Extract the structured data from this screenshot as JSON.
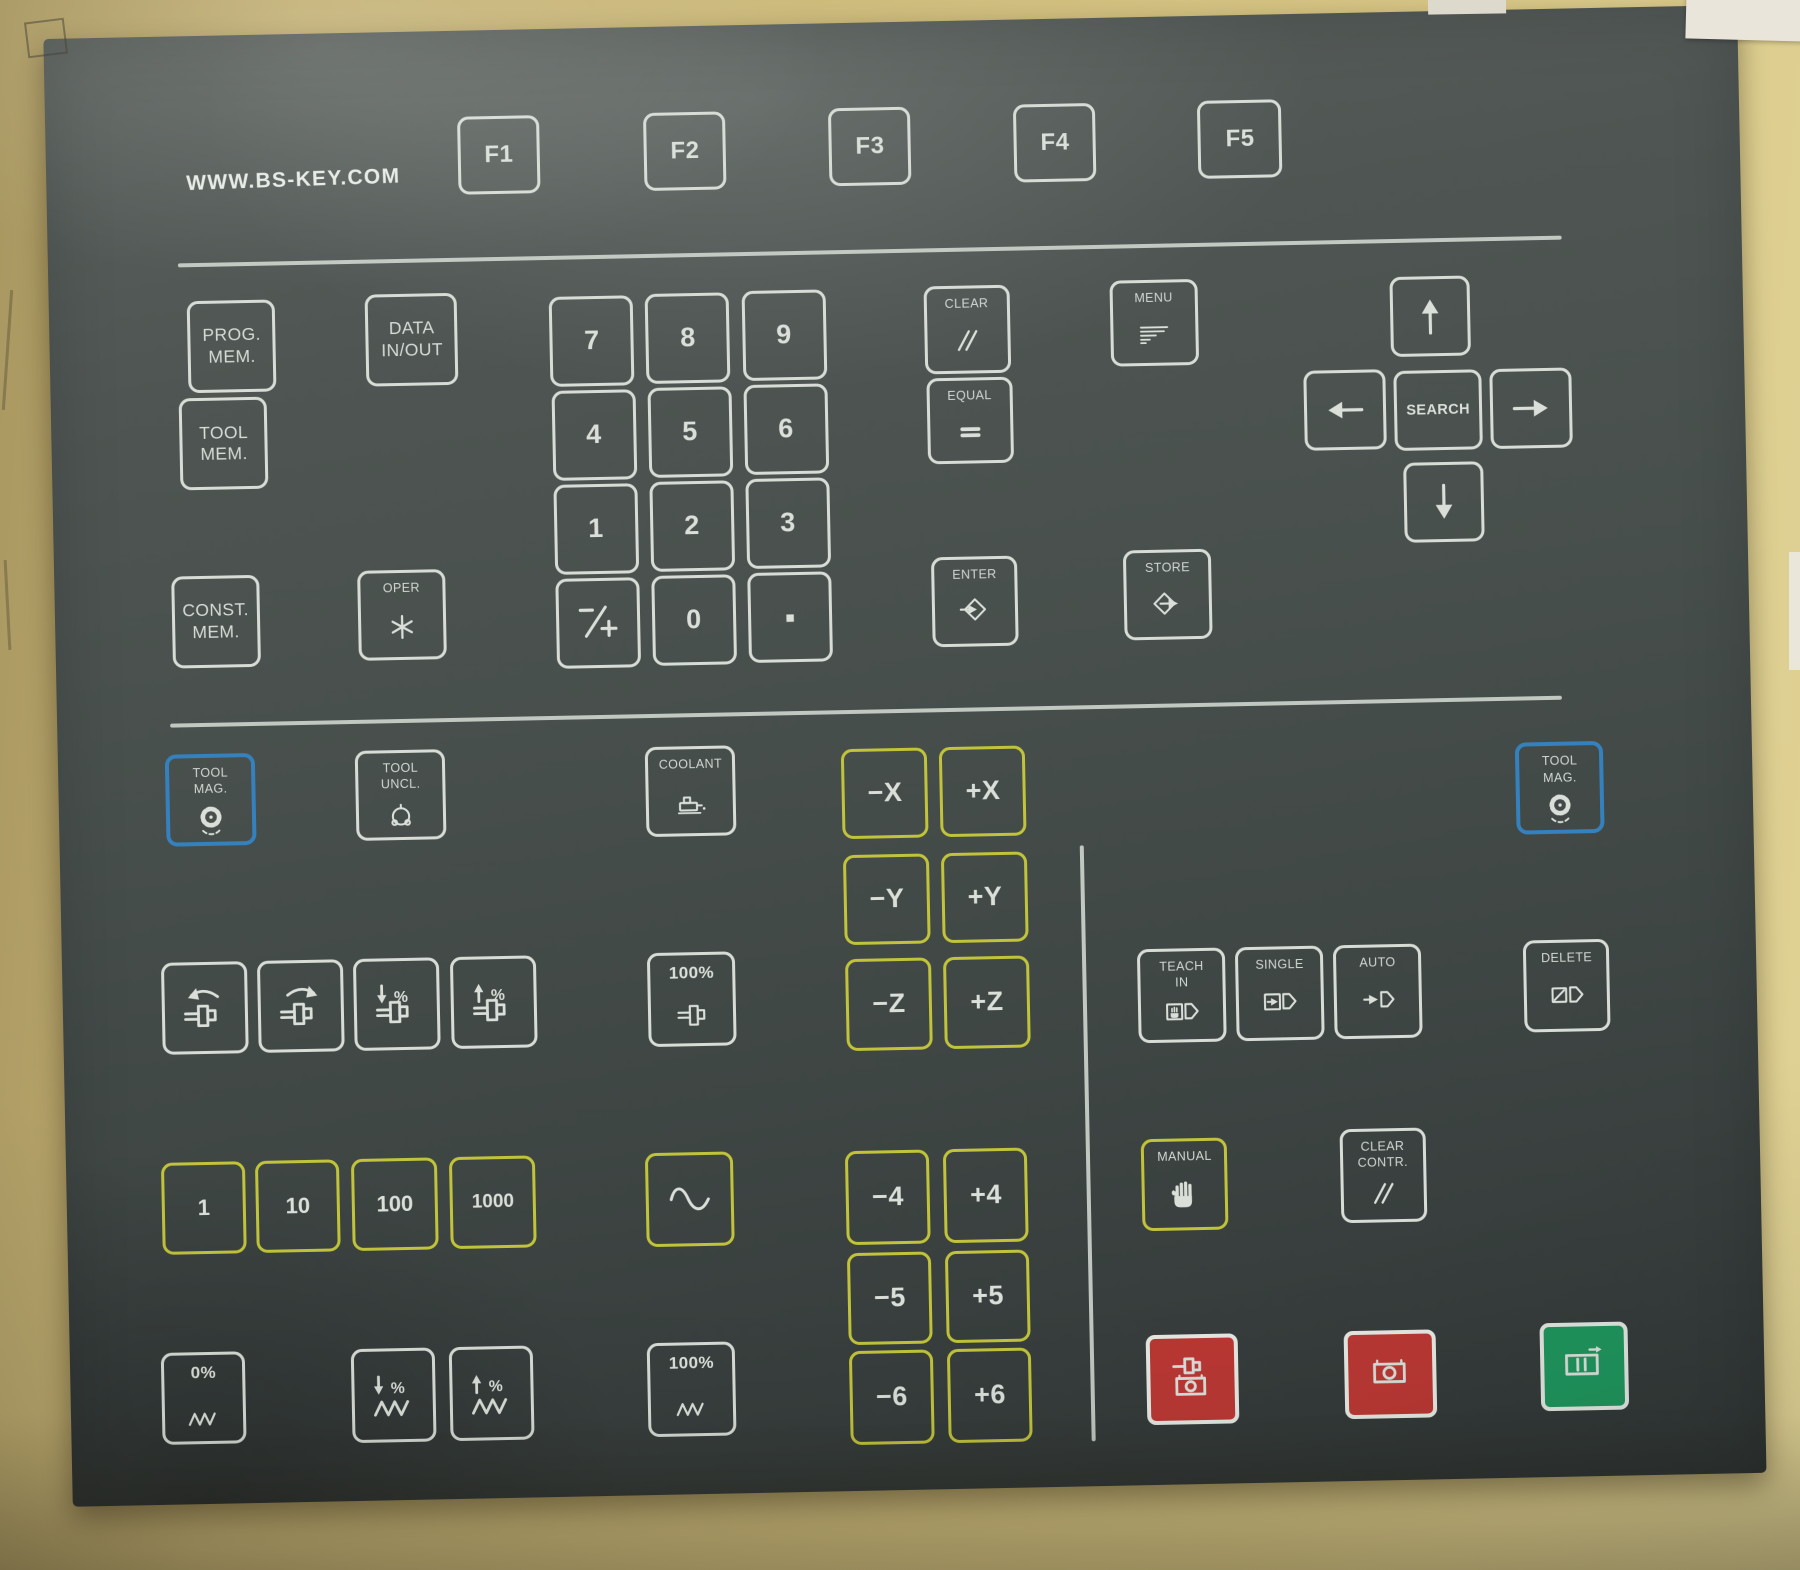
{
  "brand": "WWW.BS-KEY.COM",
  "colors": {
    "panel": "#454d4a",
    "key_outline": "#d7dcd6",
    "yellow": "#c2c431",
    "blue": "#2f82c4",
    "red": "#c23531",
    "green": "#18965a",
    "cardboard": "#cfbd7e"
  },
  "keys": {
    "f1": {
      "style": "white",
      "text": "F1"
    },
    "f2": {
      "style": "white",
      "text": "F2"
    },
    "f3": {
      "style": "white",
      "text": "F3"
    },
    "f4": {
      "style": "white",
      "text": "F4"
    },
    "f5": {
      "style": "white",
      "text": "F5"
    },
    "prog_mem": {
      "style": "white",
      "caption": [
        "PROG.",
        "MEM."
      ]
    },
    "data_in_out": {
      "style": "white",
      "caption": [
        "DATA",
        "IN/OUT"
      ]
    },
    "tool_mem": {
      "style": "white",
      "caption": [
        "TOOL",
        "MEM."
      ]
    },
    "const_mem": {
      "style": "white",
      "caption": [
        "CONST.",
        "MEM."
      ]
    },
    "oper": {
      "style": "white",
      "caption": [
        "OPER"
      ],
      "icon": "asterisk"
    },
    "d7": {
      "style": "white",
      "text": "7"
    },
    "d8": {
      "style": "white",
      "text": "8"
    },
    "d9": {
      "style": "white",
      "text": "9"
    },
    "d4": {
      "style": "white",
      "text": "4"
    },
    "d5": {
      "style": "white",
      "text": "5"
    },
    "d6": {
      "style": "white",
      "text": "6"
    },
    "d1": {
      "style": "white",
      "text": "1"
    },
    "d2": {
      "style": "white",
      "text": "2"
    },
    "d3": {
      "style": "white",
      "text": "3"
    },
    "plus_minus": {
      "style": "white",
      "icon": "plusminus"
    },
    "d0": {
      "style": "white",
      "text": "0"
    },
    "decimal": {
      "style": "white",
      "icon": "dot"
    },
    "clear": {
      "style": "white",
      "caption": [
        "CLEAR"
      ],
      "icon": "slashes"
    },
    "equal": {
      "style": "white",
      "caption": [
        "EQUAL"
      ],
      "icon": "equals"
    },
    "menu": {
      "style": "white",
      "caption": [
        "MENU"
      ],
      "icon": "menu"
    },
    "enter": {
      "style": "white",
      "caption": [
        "ENTER"
      ],
      "icon": "enter"
    },
    "store": {
      "style": "white",
      "caption": [
        "STORE"
      ],
      "icon": "store"
    },
    "arrow_up": {
      "style": "white",
      "icon": "arrow-up"
    },
    "arrow_left": {
      "style": "white",
      "icon": "arrow-left"
    },
    "search": {
      "style": "white",
      "text": "SEARCH"
    },
    "arrow_right": {
      "style": "white",
      "icon": "arrow-right"
    },
    "arrow_down": {
      "style": "white",
      "icon": "arrow-down"
    },
    "tool_mag_left": {
      "style": "blue",
      "caption": [
        "TOOL",
        "MAG."
      ],
      "icon": "wheel"
    },
    "tool_uncl": {
      "style": "white",
      "caption": [
        "TOOL",
        "UNCL."
      ],
      "icon": "collet"
    },
    "coolant": {
      "style": "white",
      "caption": [
        "COOLANT"
      ],
      "icon": "coolant"
    },
    "minus_x": {
      "style": "yellow",
      "text": "−X"
    },
    "plus_x": {
      "style": "yellow",
      "text": "+X"
    },
    "tool_mag_right": {
      "style": "blue",
      "caption": [
        "TOOL",
        "MAG."
      ],
      "icon": "wheel"
    },
    "minus_y": {
      "style": "yellow",
      "text": "−Y"
    },
    "plus_y": {
      "style": "yellow",
      "text": "+Y"
    },
    "spindle_ccw": {
      "style": "white",
      "icon": "ccw-spindle"
    },
    "spindle_cw": {
      "style": "white",
      "icon": "cw-spindle"
    },
    "spindle_pct_down": {
      "style": "white",
      "icon": "pct-down-spindle"
    },
    "spindle_pct_up": {
      "style": "white",
      "icon": "pct-up-spindle"
    },
    "spindle_100": {
      "style": "white",
      "caption": [
        "100%"
      ],
      "icon": "spindle"
    },
    "minus_z": {
      "style": "yellow",
      "text": "−Z"
    },
    "plus_z": {
      "style": "yellow",
      "text": "+Z"
    },
    "teach_in": {
      "style": "white",
      "caption": [
        "TEACH",
        "IN"
      ],
      "icon": "teach-in"
    },
    "single": {
      "style": "white",
      "caption": [
        "SINGLE"
      ],
      "icon": "single"
    },
    "auto": {
      "style": "white",
      "caption": [
        "AUTO"
      ],
      "icon": "auto"
    },
    "delete": {
      "style": "white",
      "caption": [
        "DELETE"
      ],
      "icon": "delete"
    },
    "inc_1": {
      "style": "yellow",
      "text": "1"
    },
    "inc_10": {
      "style": "yellow",
      "text": "10"
    },
    "inc_100": {
      "style": "yellow",
      "text": "100"
    },
    "inc_1000": {
      "style": "yellow",
      "text": "1000"
    },
    "wave": {
      "style": "yellow",
      "icon": "sine"
    },
    "minus_4": {
      "style": "yellow",
      "text": "−4"
    },
    "plus_4": {
      "style": "yellow",
      "text": "+4"
    },
    "manual": {
      "style": "yellow",
      "caption": [
        "MANUAL"
      ],
      "icon": "hand"
    },
    "clear_contr": {
      "style": "white",
      "caption": [
        "CLEAR",
        "CONTR."
      ],
      "icon": "slashes"
    },
    "minus_5": {
      "style": "yellow",
      "text": "−5"
    },
    "plus_5": {
      "style": "yellow",
      "text": "+5"
    },
    "feed_0": {
      "style": "white",
      "caption": [
        "0%"
      ],
      "icon": "zigzag"
    },
    "feed_pct_down": {
      "style": "white",
      "icon": "pct-down-zigzag"
    },
    "feed_pct_up": {
      "style": "white",
      "icon": "pct-up-zigzag"
    },
    "feed_100": {
      "style": "white",
      "caption": [
        "100%"
      ],
      "icon": "zigzag"
    },
    "minus_6": {
      "style": "yellow",
      "text": "−6"
    },
    "plus_6": {
      "style": "yellow",
      "text": "+6"
    },
    "spindle_feed_stop": {
      "style": "red",
      "icon": "spindle-stop"
    },
    "feed_stop": {
      "style": "red",
      "icon": "feed-stop"
    },
    "feed_start": {
      "style": "green",
      "icon": "feed-start"
    }
  }
}
